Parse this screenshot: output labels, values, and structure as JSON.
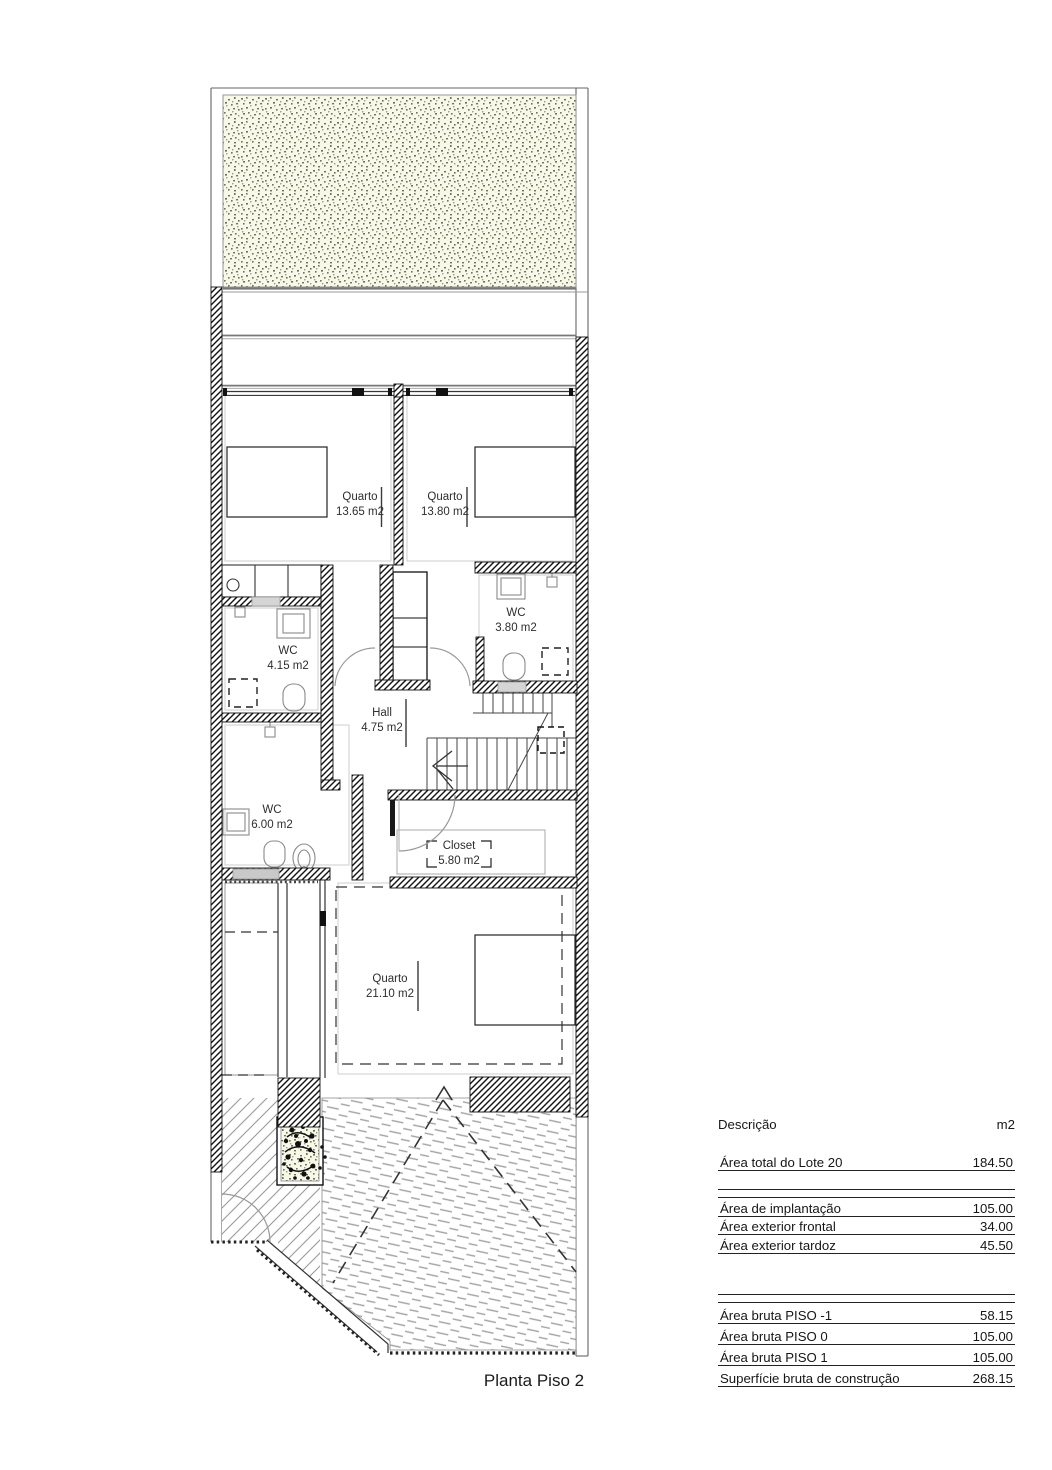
{
  "title": "Planta Piso 2",
  "rooms": [
    {
      "name": "Quarto",
      "area": "13.65 m2"
    },
    {
      "name": "Quarto",
      "area": "13.80 m2"
    },
    {
      "name": "WC",
      "area": "4.15 m2"
    },
    {
      "name": "WC",
      "area": "3.80 m2"
    },
    {
      "name": "Hall",
      "area": "4.75 m2"
    },
    {
      "name": "WC",
      "area": "6.00 m2"
    },
    {
      "name": "Closet",
      "area": "5.80 m2"
    },
    {
      "name": "Quarto",
      "area": "21.10 m2"
    }
  ],
  "areas_table": {
    "header": {
      "description": "Descrição",
      "unit": "m2"
    },
    "groups": [
      {
        "rows": [
          {
            "label": "Área total do Lote 20",
            "value": "184.50"
          }
        ]
      },
      {
        "rows": [
          {
            "label": "Área de implantação",
            "value": "105.00"
          },
          {
            "label": "Área exterior frontal",
            "value": "34.00"
          },
          {
            "label": "Área exterior tardoz",
            "value": "45.50"
          }
        ]
      },
      {
        "rows": [
          {
            "label": "Área bruta PISO -1",
            "value": "58.15"
          },
          {
            "label": "Área bruta PISO 0",
            "value": "105.00"
          },
          {
            "label": "Área bruta PISO 1",
            "value": "105.00"
          },
          {
            "label": "Superfície bruta de construção",
            "value": "268.15"
          }
        ]
      }
    ]
  },
  "colors": {
    "ink": "#111111",
    "line_gray": "#888888",
    "roof_dash": "#a2a2a2",
    "stipple_bg": "#f7f8ea",
    "stipple_dot": "#6e7250"
  }
}
